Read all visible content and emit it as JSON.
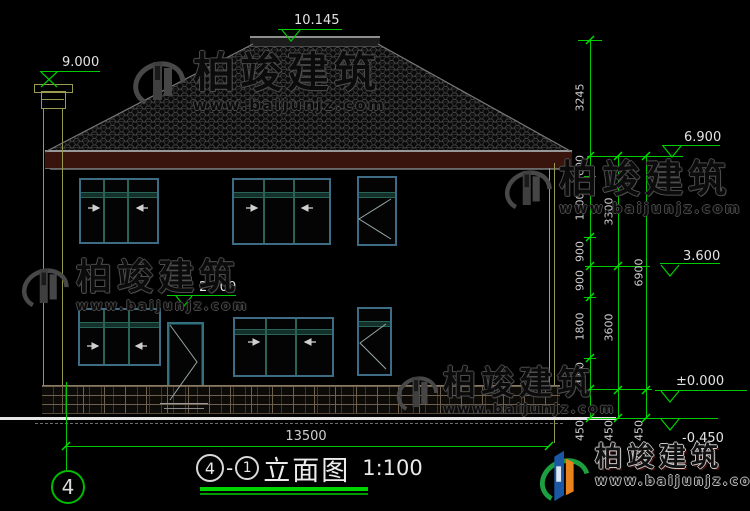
{
  "drawing": {
    "grid_bubble": "4",
    "title": {
      "axis_start": "4",
      "separator": "-",
      "axis_end": "1",
      "name": "立面图",
      "scale": "1:100"
    },
    "elevations": {
      "ridge": "10.145",
      "chimney": "9.000",
      "eave": "6.900",
      "level2": "3.600",
      "door_top": "2.700",
      "zero": "±0.000",
      "ground": "-0.450"
    },
    "dimensions": {
      "total_width": "13500",
      "chain_a": [
        "3245",
        "600",
        "1800",
        "900",
        "900",
        "1800",
        "900",
        "450"
      ],
      "chain_b": [
        "3300",
        "3600",
        "450"
      ],
      "chain_c": [
        "6900",
        "450"
      ]
    }
  },
  "watermark": {
    "brand": "柏竣建筑",
    "url": "www.baijunjz.com"
  },
  "colors": {
    "annotation_green": "#00cc00",
    "window_frame": "#3f6c85",
    "window_mullion": "#2a6457",
    "fascia_maroon": "#38140c",
    "axis_olive": "#99994d",
    "ground_white": "#e5e5e5"
  }
}
